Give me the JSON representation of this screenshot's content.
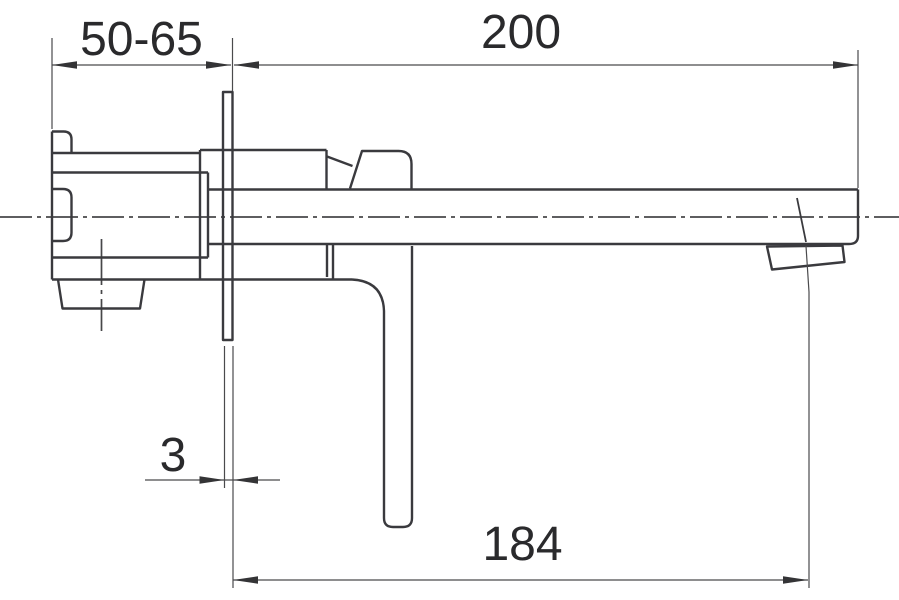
{
  "drawing": {
    "kind": "technical-dimension-drawing",
    "subject": "wall-mounted-faucet-side-view",
    "colors": {
      "object_line": "#3a3a3e",
      "dimension_line": "#4a4a4c",
      "text": "#2a2a2c",
      "background": "#ffffff"
    },
    "dimensions": {
      "embed_depth_range": {
        "value": "50-65"
      },
      "spout_length": {
        "value": "200"
      },
      "plate_thickness": {
        "value": "3"
      },
      "outlet_reach": {
        "value": "184"
      }
    }
  }
}
